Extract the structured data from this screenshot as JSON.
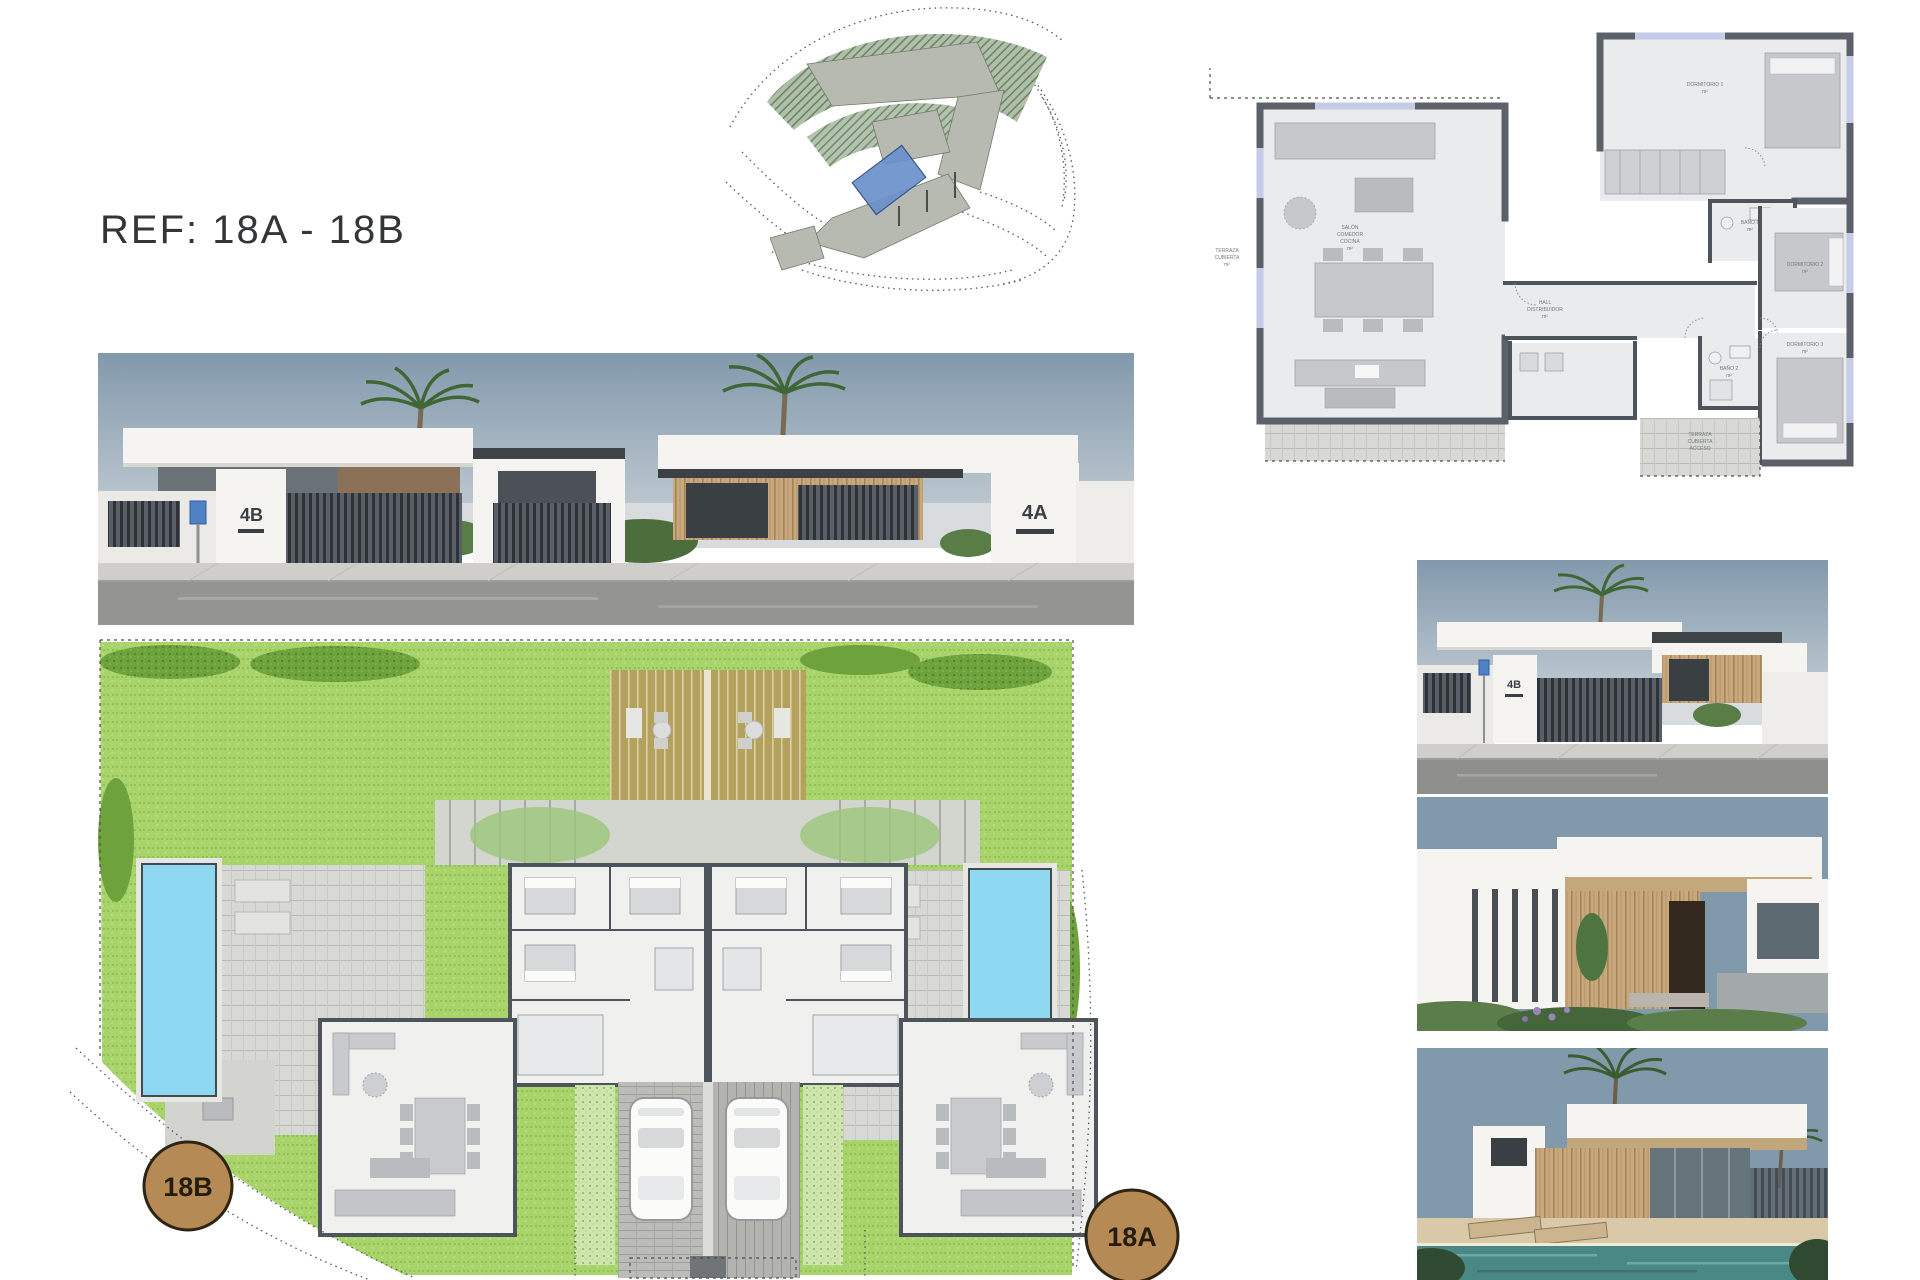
{
  "page": {
    "ref_label": "REF: 18A - 18B",
    "background": "#ffffff"
  },
  "street_render": {
    "house_left_number": "4B",
    "house_right_number": "4A"
  },
  "site_plan": {
    "plot_left_label": "18B",
    "plot_right_label": "18A",
    "badge_color": "#b58a55",
    "grass_color": "#a9d36b",
    "pool_color": "#8fd8f2",
    "deck_color": "#b4a15e"
  },
  "side_renders": {
    "street_house_number": "4B"
  },
  "floor_plan": {
    "terrace_left": {
      "l1": "TERRAZA",
      "l2": "CUBIERTA",
      "l3": "m²"
    },
    "living": {
      "l1": "SALÓN",
      "l2": "COMEDOR",
      "l3": "COCINA",
      "l4": "m²"
    },
    "hall": {
      "l1": "HALL",
      "l2": "DISTRIBUIDOR",
      "l3": "m²"
    },
    "bedroom1": {
      "l1": "DORMITORIO 1",
      "l2": "m²"
    },
    "bedroom2": {
      "l1": "DORMITORIO 2",
      "l2": "m²"
    },
    "bedroom3": {
      "l1": "DORMITORIO 3",
      "l2": "m²"
    },
    "bath1": {
      "l1": "BAÑO 1",
      "l2": "m²"
    },
    "bath2": {
      "l1": "BAÑO 2",
      "l2": "m²"
    },
    "terrace_bottom": {
      "l1": "TERRAZA",
      "l2": "CUBIERTA",
      "l3": "ACCESO"
    }
  },
  "colors": {
    "sky": "#8099ab",
    "road": "#8f8f8d",
    "wood": "#c8a87d",
    "wall_dark": "#5c6169",
    "topo_parcel": "#b7bab1",
    "topo_highlight": "#6b91cc"
  }
}
